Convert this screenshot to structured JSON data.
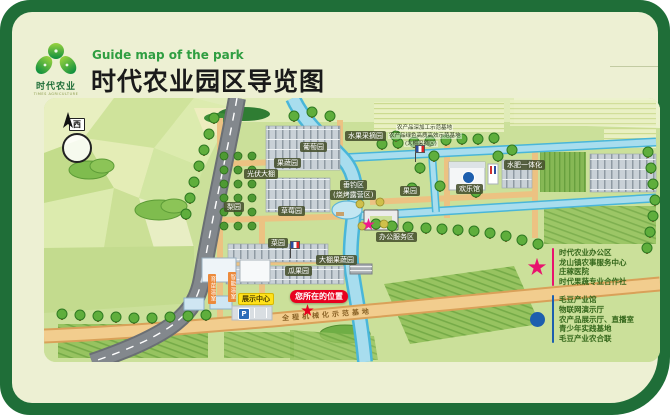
{
  "header": {
    "logo_title": "时代农业",
    "logo_subtitle": "TIMES AGRICULTURE",
    "subtitle_en": "Guide map of the park",
    "title": "时代农业园区导览图"
  },
  "map": {
    "compass_label": "西",
    "parking_label": "P",
    "labels": [
      {
        "text": "水果采摘园",
        "x": 301,
        "y": 33,
        "type": "chip"
      },
      {
        "text": "葡萄园",
        "x": 256,
        "y": 44,
        "type": "chip"
      },
      {
        "text": "果蔬园",
        "x": 230,
        "y": 60,
        "type": "chip"
      },
      {
        "text": "光伏大棚",
        "x": 200,
        "y": 71,
        "type": "chip"
      },
      {
        "text": "垂钓区",
        "x": 296,
        "y": 82,
        "type": "chip"
      },
      {
        "text": "(烧烤露营区)",
        "x": 286,
        "y": 92,
        "type": "chip"
      },
      {
        "text": "果园",
        "x": 356,
        "y": 88,
        "type": "chip"
      },
      {
        "text": "欢乐馆",
        "x": 412,
        "y": 86,
        "type": "chip"
      },
      {
        "text": "水肥一体化",
        "x": 460,
        "y": 62,
        "type": "chip"
      },
      {
        "text": "梨园",
        "x": 180,
        "y": 104,
        "type": "chip"
      },
      {
        "text": "草莓园",
        "x": 234,
        "y": 108,
        "type": "chip"
      },
      {
        "text": "菜园",
        "x": 224,
        "y": 140,
        "type": "chip"
      },
      {
        "text": "瓜果园",
        "x": 241,
        "y": 168,
        "type": "chip"
      },
      {
        "text": "大棚果蔬园",
        "x": 272,
        "y": 157,
        "type": "chip"
      },
      {
        "text": "办公服务区",
        "x": 332,
        "y": 134,
        "type": "chip"
      },
      {
        "text": "展示中心",
        "x": 194,
        "y": 195,
        "type": "yellow"
      },
      {
        "text": "您所在的位置",
        "x": 246,
        "y": 192,
        "type": "red"
      },
      {
        "text": "育苗温室",
        "x": 164,
        "y": 176,
        "type": "vchip"
      },
      {
        "text": "智能温室",
        "x": 184,
        "y": 174,
        "type": "vchip"
      },
      {
        "text": "农产品深加工示范基地",
        "x": 352,
        "y": 27,
        "type": "tiny"
      },
      {
        "text": "农产品绿色高质高效示范基地",
        "x": 344,
        "y": 35,
        "type": "tiny"
      },
      {
        "text": "(大棚采摘区)",
        "x": 360,
        "y": 43,
        "type": "tiny"
      },
      {
        "text": "全程机械化示范基地",
        "x": 238,
        "y": 213,
        "type": "road"
      }
    ],
    "markers": [
      {
        "kind": "star-pink",
        "x": 318,
        "y": 120,
        "color": "#f0188c"
      },
      {
        "kind": "star-red",
        "x": 257,
        "y": 206,
        "color": "#e8001f"
      },
      {
        "kind": "dot-blue",
        "x": 418,
        "y": 73,
        "color": "#1d5fae"
      },
      {
        "kind": "flag",
        "x": 246,
        "y": 143
      },
      {
        "kind": "flag",
        "x": 371,
        "y": 47
      },
      {
        "kind": "parking",
        "x": 194,
        "y": 210
      }
    ]
  },
  "legend": {
    "star_group": {
      "color": "#e8136e",
      "items": [
        "时代农业办公区",
        "龙山镇农事服务中心",
        "庄稼医院",
        "时代果蔬专业合作社"
      ]
    },
    "dot_group": {
      "color": "#1d5fae",
      "items": [
        "毛豆产业馆",
        "物联网演示厅",
        "农产品展示厅、直播室",
        "青少年实践基地",
        "毛豆产业农合联"
      ]
    }
  }
}
